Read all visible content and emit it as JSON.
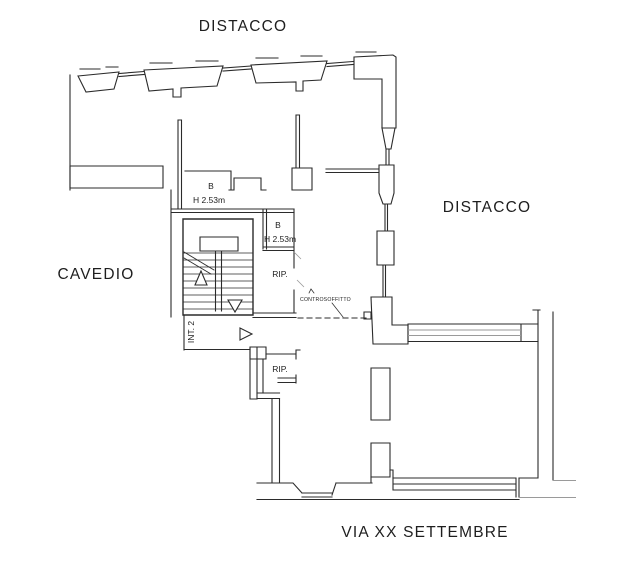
{
  "labels": {
    "distacco_top": "DISTACCO",
    "distacco_right": "DISTACCO",
    "cavedio": "CAVEDIO",
    "street": "VIA XX SETTEMBRE"
  },
  "rooms": {
    "bath_upper": {
      "code": "B",
      "ceiling_height": "H 2.53m"
    },
    "bath_inner": {
      "code": "B",
      "ceiling_height": "H 2.53m"
    },
    "storage_upper": {
      "label": "RIP."
    },
    "storage_lower": {
      "label": "RIP."
    },
    "entrance": {
      "label": "INT. 2"
    },
    "ceiling_note": {
      "label": "CONTROSOFFITTO"
    }
  },
  "colors": {
    "wall": "#2b2b2b",
    "light": "#9a9a9a",
    "text": "#1e1e1e",
    "background": "#ffffff"
  }
}
